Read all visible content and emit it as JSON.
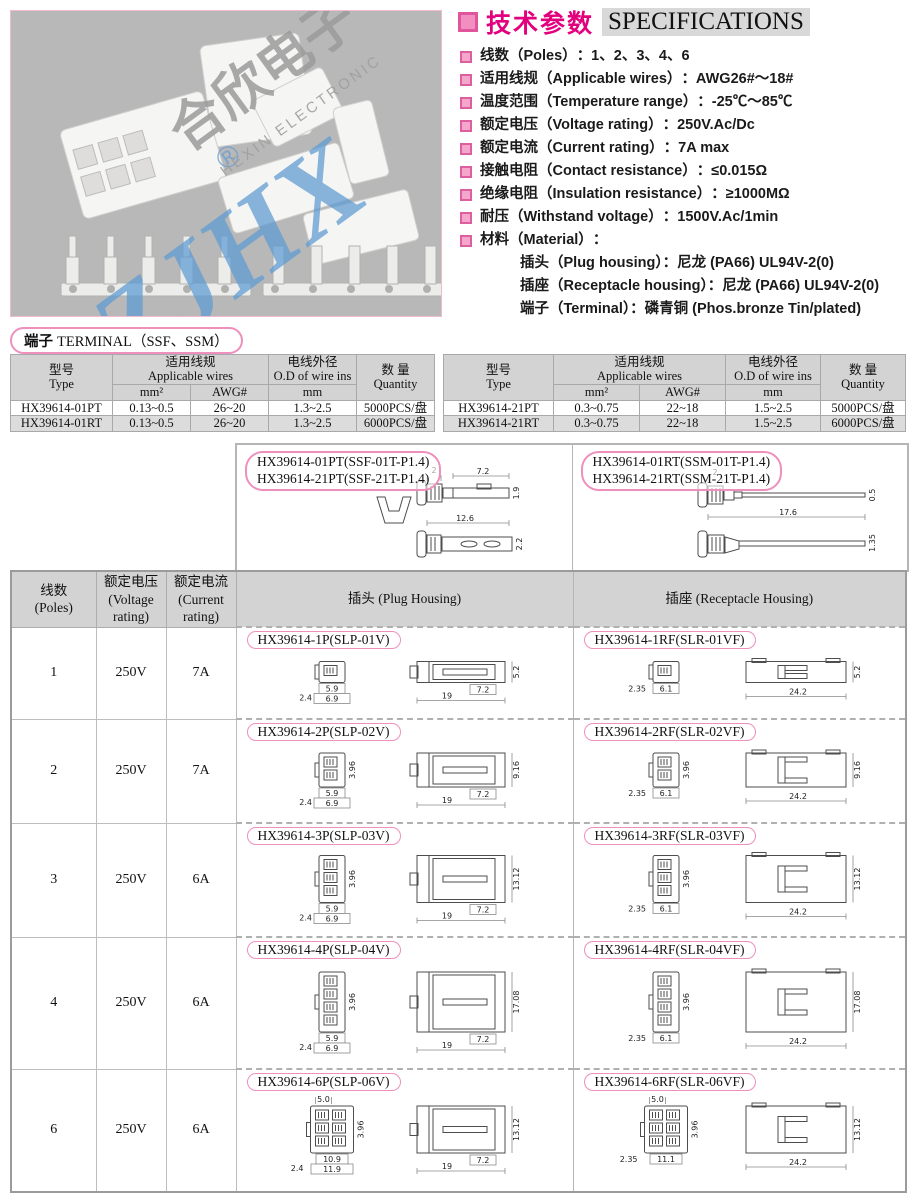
{
  "photo": {
    "watermark": {
      "brand": "ZJHX",
      "reg": "®",
      "cn": "合欣电子",
      "en": "HEXIN ELECTRONIC"
    }
  },
  "specs": {
    "title_cn": "技术参数",
    "title_en": "SPECIFICATIONS",
    "items": [
      {
        "label": "线数（Poles）",
        "value": "：1、2、3、4、6"
      },
      {
        "label": "适用线规（Applicable wires）",
        "value": "：AWG26#～18#"
      },
      {
        "label": "温度范围（Temperature range）",
        "value": "：-25℃～85℃"
      },
      {
        "label": "额定电压（Voltage rating）",
        "value": "：250V.Ac/Dc"
      },
      {
        "label": "额定电流（Current rating）",
        "value": "：7A max"
      },
      {
        "label": "接触电阻（Contact resistance）",
        "value": "：≤0.015Ω"
      },
      {
        "label": "绝缘电阻（Insulation resistance）",
        "value": "：≥1000MΩ"
      },
      {
        "label": "耐压（Withstand voltage）",
        "value": "：1500V.Ac/1min"
      },
      {
        "label": "材料（Material）",
        "value": "："
      }
    ],
    "material_sublines": [
      "插头（Plug housing）：尼龙 (PA66) UL94V-2(0)",
      "插座（Receptacle housing）：尼龙 (PA66) UL94V-2(0)",
      "端子（Terminal）：磷青铜 (Phos.bronze Tin/plated)"
    ]
  },
  "terminal_section": {
    "title_cn": "端子",
    "title_rest": "TERMINAL（SSF、SSM）",
    "col_headers": {
      "type_cn": "型号",
      "type_en": "Type",
      "wires_cn": "适用线规",
      "wires_en": "Applicable wires",
      "mm2": "mm²",
      "awg": "AWG#",
      "od_cn": "电线外径",
      "od_en": "O.D of wire ins",
      "od_unit": "mm",
      "qty_cn": "数 量",
      "qty_en": "Quantity"
    },
    "tables": [
      {
        "rows": [
          [
            "HX39614-01PT",
            "0.13~0.5",
            "26~20",
            "1.3~2.5",
            "5000PCS/盘"
          ],
          [
            "HX39614-01RT",
            "0.13~0.5",
            "26~20",
            "1.3~2.5",
            "6000PCS/盘"
          ]
        ]
      },
      {
        "rows": [
          [
            "HX39614-21PT",
            "0.3~0.75",
            "22~18",
            "1.5~2.5",
            "5000PCS/盘"
          ],
          [
            "HX39614-21RT",
            "0.3~0.75",
            "22~18",
            "1.5~2.5",
            "6000PCS/盘"
          ]
        ]
      }
    ]
  },
  "terminal_drawings": {
    "ssf": {
      "labels": [
        "HX39614-01PT(SSF-01T-P1.4)",
        "HX39614-21PT(SSF-21T-P1.4)"
      ],
      "dims": {
        "top_w": "2",
        "tab_w": "7.2",
        "h1": "1.9",
        "len": "12.6",
        "h2": "2.2"
      }
    },
    "ssm": {
      "labels": [
        "HX39614-01RT(SSM-01T-P1.4)",
        "HX39614-21RT(SSM-21T-P1.4)"
      ],
      "dims": {
        "top_w": "2",
        "h1": "0.5",
        "len": "17.6",
        "h2": "1.35"
      }
    }
  },
  "main_table": {
    "headers": {
      "poles_cn": "线数",
      "poles_en": "(Poles)",
      "voltage_cn": "额定电压",
      "voltage_en": "(Voltage rating)",
      "current_cn": "额定电流",
      "current_en": "(Current rating)",
      "plug_cn": "插头",
      "plug_en": "(Plug Housing)",
      "receptacle_cn": "插座",
      "receptacle_en": "(Receptacle Housing)"
    },
    "rows": [
      {
        "poles": "1",
        "poles_num": 1,
        "voltage": "250V",
        "current": "7A",
        "plug": {
          "label": "HX39614-1P(SLP-01V)",
          "front": {
            "left": "2.4",
            "w1": "5.9",
            "w2": "6.9"
          },
          "side": {
            "len": "19",
            "tab": "7.2",
            "h": "5.2"
          }
        },
        "receptacle": {
          "label": "HX39614-1RF(SLR-01VF)",
          "front": {
            "left": "2.35",
            "w1": "6.1"
          },
          "side": {
            "len": "24.2",
            "h": "5.2"
          }
        }
      },
      {
        "poles": "2",
        "poles_num": 2,
        "voltage": "250V",
        "current": "7A",
        "plug": {
          "label": "HX39614-2P(SLP-02V)",
          "front": {
            "left": "2.4",
            "w1": "5.9",
            "w2": "6.9",
            "pitch": "3.96"
          },
          "side": {
            "len": "19",
            "tab": "7.2",
            "h": "9.16"
          }
        },
        "receptacle": {
          "label": "HX39614-2RF(SLR-02VF)",
          "front": {
            "left": "2.35",
            "w1": "6.1",
            "pitch": "3.96"
          },
          "side": {
            "len": "24.2",
            "h": "9.16"
          }
        }
      },
      {
        "poles": "3",
        "poles_num": 3,
        "voltage": "250V",
        "current": "6A",
        "plug": {
          "label": "HX39614-3P(SLP-03V)",
          "front": {
            "left": "2.4",
            "w1": "5.9",
            "w2": "6.9",
            "pitch": "3.96"
          },
          "side": {
            "len": "19",
            "tab": "7.2",
            "h": "13.12"
          }
        },
        "receptacle": {
          "label": "HX39614-3RF(SLR-03VF)",
          "front": {
            "left": "2.35",
            "w1": "6.1",
            "pitch": "3.96"
          },
          "side": {
            "len": "24.2",
            "h": "13.12"
          }
        }
      },
      {
        "poles": "4",
        "poles_num": 4,
        "voltage": "250V",
        "current": "6A",
        "plug": {
          "label": "HX39614-4P(SLP-04V)",
          "front": {
            "left": "2.4",
            "w1": "5.9",
            "w2": "6.9",
            "pitch": "3.96"
          },
          "side": {
            "len": "19",
            "tab": "7.2",
            "h": "17.08"
          }
        },
        "receptacle": {
          "label": "HX39614-4RF(SLR-04VF)",
          "front": {
            "left": "2.35",
            "w1": "6.1",
            "pitch": "3.96"
          },
          "side": {
            "len": "24.2",
            "h": "17.08"
          }
        }
      },
      {
        "poles": "6",
        "poles_num": 6,
        "voltage": "250V",
        "current": "6A",
        "plug": {
          "label": "HX39614-6P(SLP-06V)",
          "front": {
            "top": "5.0",
            "left": "2.4",
            "w1": "10.9",
            "w2": "11.9",
            "pitch": "3.96"
          },
          "side": {
            "len": "19",
            "tab": "7.2",
            "h": "13.12"
          }
        },
        "receptacle": {
          "label": "HX39614-6RF(SLR-06VF)",
          "front": {
            "top": "5.0",
            "left": "2.35",
            "w1": "11.1",
            "pitch": "3.96"
          },
          "side": {
            "len": "24.2",
            "h": "13.12"
          }
        }
      }
    ]
  }
}
